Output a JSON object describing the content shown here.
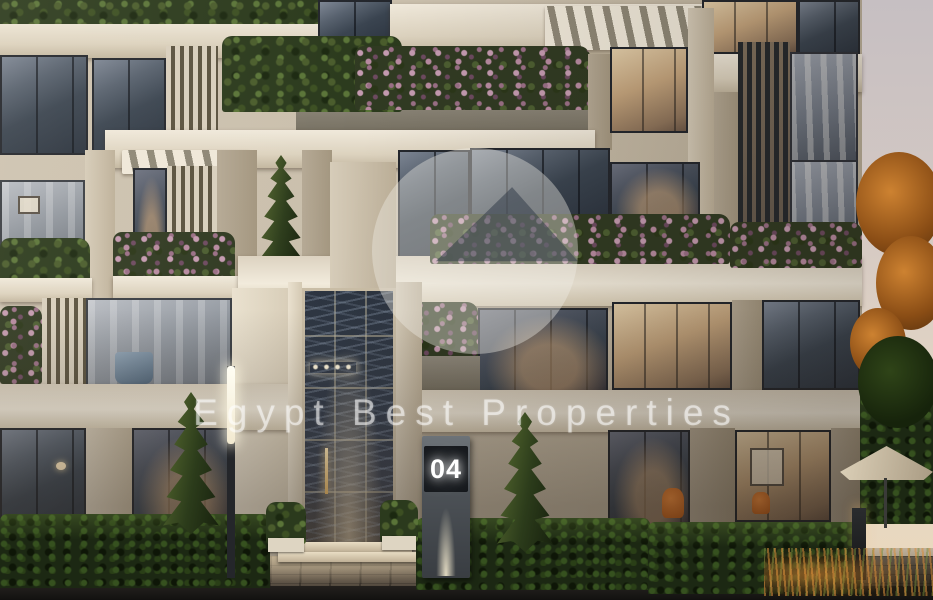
{
  "scene": {
    "type": "architectural-exterior-render",
    "time_of_day": "dusk",
    "building_number": "04",
    "description": "Modern residential building facade with planted balconies, louvered screens, glazed double-height entrance lobby, hedges, cypress trees and a paved walkway at dusk"
  },
  "watermark": {
    "text": "Egypt Best Properties",
    "logo": "circle-with-pyramid"
  },
  "palette": {
    "facade_cream": "#cec4b2",
    "fascia_light": "#f0e9db",
    "window_glass": "#3a4450",
    "warm_interior": "#e2cda9",
    "foliage_dark": "#2b3a1d",
    "flower_pink": "#c49ab0",
    "hedge_green": "#1c2813",
    "sky_dusk_top": "#c6bfc2",
    "sky_dusk_bottom": "#ead8bd",
    "pavement": "#5d5246",
    "autumn_leaves": "#cd8231",
    "accent_orange": "#f08c3c"
  }
}
